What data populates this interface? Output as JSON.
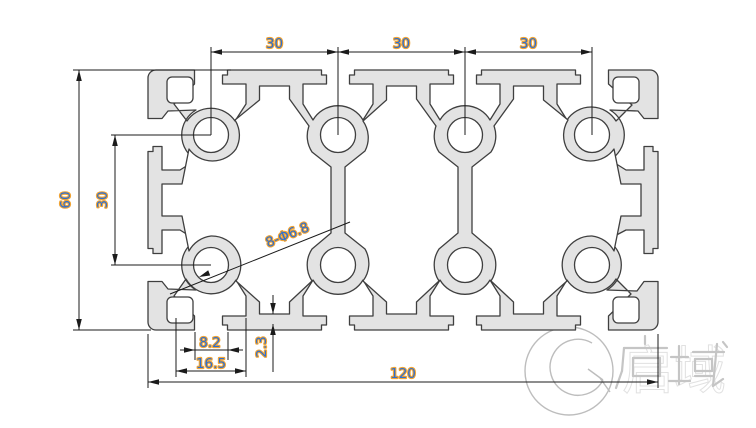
{
  "drawing": {
    "type": "aluminum-extrusion-profile-cross-section",
    "dimensions": {
      "top_spacing": [
        "30",
        "30",
        "30"
      ],
      "overall_height": "60",
      "hole_row_spacing": "30",
      "hole_callout": "8-Φ6.8",
      "slot_opening_width": "8.2",
      "slot_inner_width": "16.5",
      "slot_lip_thickness": "2.3",
      "overall_width": "120"
    },
    "watermark_text": "启域",
    "colors": {
      "dim_text": "#2e6fd0",
      "dim_text_halo": "#f0a435",
      "profile_fill": "#e3e3e3",
      "profile_outline": "#3f3f3f",
      "dim_line": "#1b1b1b",
      "watermark": "#c5c5c5"
    }
  }
}
